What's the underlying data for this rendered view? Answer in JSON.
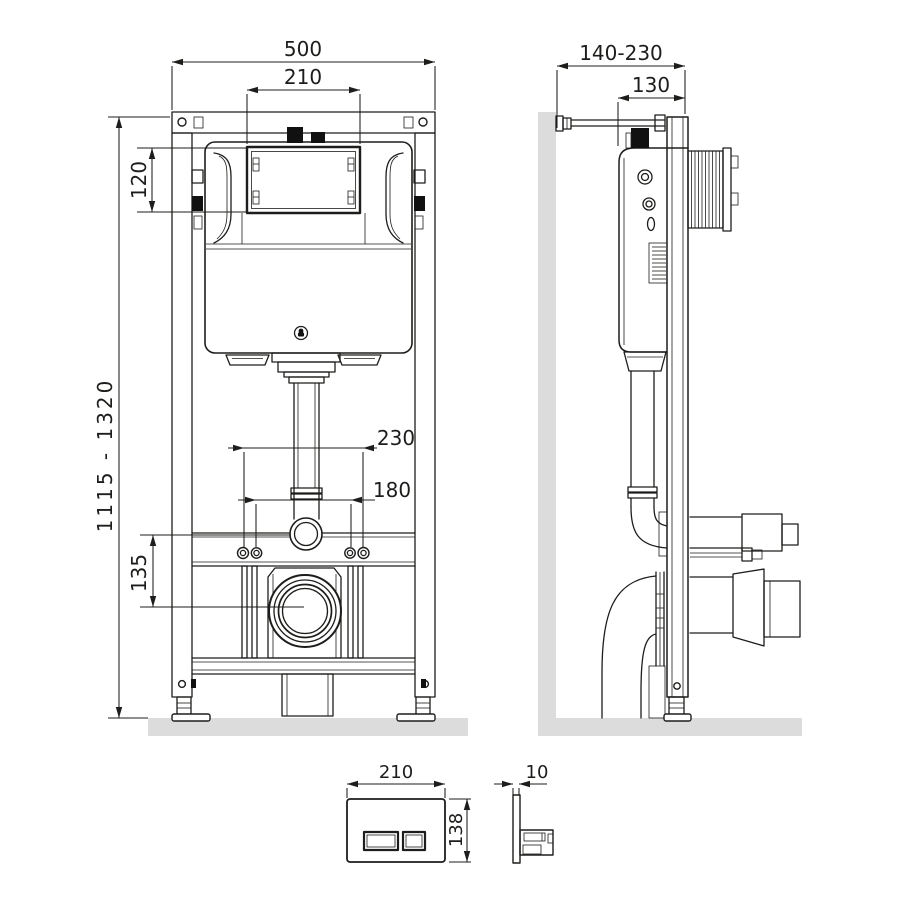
{
  "views": {
    "front": {
      "dims": {
        "overall_width": "500",
        "window_width": "210",
        "window_height": "120",
        "height_range": "1115 - 1320",
        "bolt_spacing_outer": "230",
        "bolt_spacing_inner": "180",
        "outlet_center_height": "135"
      }
    },
    "side": {
      "dims": {
        "wall_offset_range": "140-230",
        "frame_depth": "130"
      }
    },
    "plate_front": {
      "dims": {
        "width": "210",
        "height": "138"
      }
    },
    "plate_side": {
      "dims": {
        "thickness": "10"
      }
    }
  },
  "colors": {
    "line": "#1d1d1b",
    "surface_gray": "#dcdcdc",
    "black_fill": "#111111",
    "background": "#ffffff"
  }
}
